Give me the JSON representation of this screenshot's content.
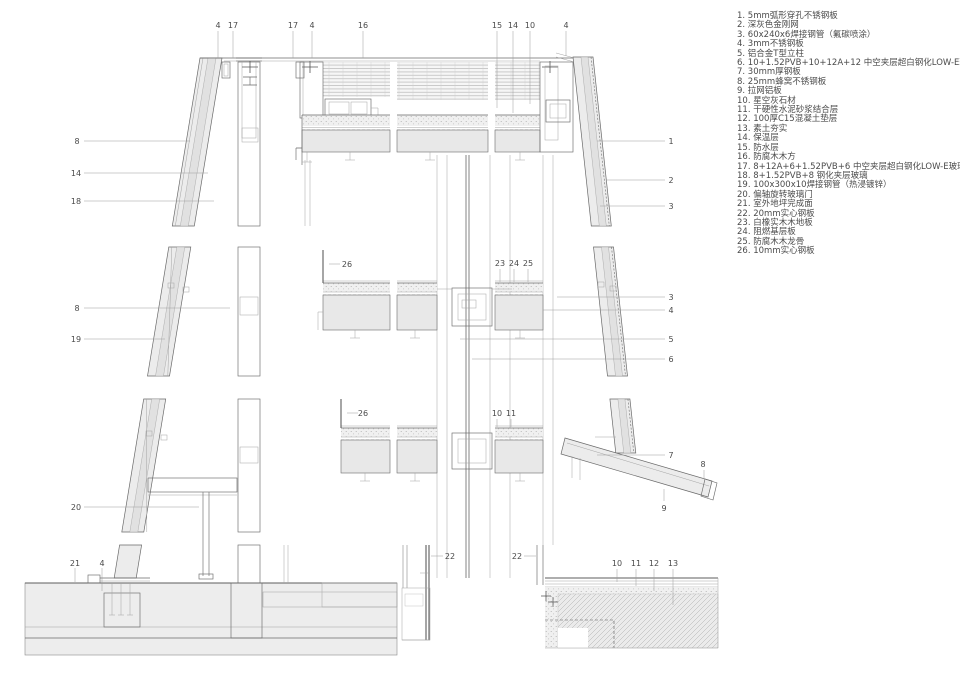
{
  "colors": {
    "line": "#6a6a6a",
    "line_light": "#a3a3a3",
    "fill": "#ececec",
    "slab": "#e8e8e8",
    "text": "#4a4a4a"
  },
  "legend": {
    "items": [
      {
        "num": "1",
        "text": "5mm弧形穿孔不锈钢板"
      },
      {
        "num": "2",
        "text": "深灰色金刚网"
      },
      {
        "num": "3",
        "text": "60x240x6焊接钢管（氟碳喷涂）"
      },
      {
        "num": "4",
        "text": "3mm不锈钢板"
      },
      {
        "num": "5",
        "text": "铝合金T型立柱"
      },
      {
        "num": "6",
        "text": "10+1.52PVB+10+12A+12 中空夹层超白钢化LOW-E玻璃"
      },
      {
        "num": "7",
        "text": "30mm厚钢板"
      },
      {
        "num": "8",
        "text": "25mm蜂窝不锈钢板"
      },
      {
        "num": "9",
        "text": "拉网铝板"
      },
      {
        "num": "10",
        "text": "星空灰石材"
      },
      {
        "num": "11",
        "text": "干硬性水泥砂浆结合层"
      },
      {
        "num": "12",
        "text": "100厚C15混凝土垫层"
      },
      {
        "num": "13",
        "text": "素土夯实"
      },
      {
        "num": "14",
        "text": "保温层"
      },
      {
        "num": "15",
        "text": "防水层"
      },
      {
        "num": "16",
        "text": "防腐木木方"
      },
      {
        "num": "17",
        "text": "8+12A+6+1.52PVB+6 中空夹层超白钢化LOW-E玻璃"
      },
      {
        "num": "18",
        "text": "8+1.52PVB+8 钢化夹层玻璃"
      },
      {
        "num": "19",
        "text": "100x300x10焊接钢管（热浸镀锌）"
      },
      {
        "num": "20",
        "text": "偏轴旋转玻璃门"
      },
      {
        "num": "21",
        "text": "室外地坪完成面"
      },
      {
        "num": "22",
        "text": "20mm实心钢板"
      },
      {
        "num": "23",
        "text": "白橡实木木地板"
      },
      {
        "num": "24",
        "text": "阻燃基层板"
      },
      {
        "num": "25",
        "text": "防腐木木龙骨"
      },
      {
        "num": "26",
        "text": "10mm实心钢板"
      }
    ]
  },
  "callouts": [
    {
      "label": "4",
      "x": 218,
      "y": 25,
      "leader": [
        218,
        31,
        218,
        58
      ]
    },
    {
      "label": "17",
      "x": 233,
      "y": 25,
      "leader": [
        233,
        31,
        233,
        58
      ]
    },
    {
      "label": "17",
      "x": 293,
      "y": 25,
      "leader": [
        293,
        31,
        293,
        58
      ]
    },
    {
      "label": "4",
      "x": 312,
      "y": 25,
      "leader": [
        312,
        31,
        312,
        58
      ]
    },
    {
      "label": "16",
      "x": 363,
      "y": 25,
      "leader": [
        363,
        31,
        363,
        58
      ]
    },
    {
      "label": "15",
      "x": 497,
      "y": 25,
      "leader": [
        497,
        31,
        497,
        108
      ]
    },
    {
      "label": "14",
      "x": 513,
      "y": 25,
      "leader": [
        513,
        31,
        513,
        113
      ]
    },
    {
      "label": "10",
      "x": 530,
      "y": 25,
      "leader": [
        530,
        31,
        530,
        104
      ]
    },
    {
      "label": "4",
      "x": 566,
      "y": 25,
      "leader": [
        566,
        31,
        566,
        56
      ]
    },
    {
      "label": "8",
      "x": 77,
      "y": 141,
      "leader": [
        84,
        141,
        190,
        141
      ]
    },
    {
      "label": "14",
      "x": 76,
      "y": 173,
      "leader": [
        84,
        173,
        208,
        173
      ]
    },
    {
      "label": "18",
      "x": 76,
      "y": 201,
      "leader": [
        84,
        201,
        214,
        201
      ]
    },
    {
      "label": "8",
      "x": 77,
      "y": 308,
      "leader": [
        84,
        308,
        230,
        308
      ]
    },
    {
      "label": "19",
      "x": 76,
      "y": 339,
      "leader": [
        84,
        339,
        165,
        339
      ]
    },
    {
      "label": "20",
      "x": 76,
      "y": 507,
      "leader": [
        84,
        507,
        199,
        507
      ]
    },
    {
      "label": "21",
      "x": 75,
      "y": 563,
      "leader": [
        75,
        568,
        75,
        582
      ]
    },
    {
      "label": "4",
      "x": 102,
      "y": 563,
      "leader": [
        102,
        568,
        102,
        591
      ]
    },
    {
      "label": "1",
      "x": 671,
      "y": 141,
      "leader": [
        597,
        141,
        665,
        141
      ]
    },
    {
      "label": "2",
      "x": 671,
      "y": 180,
      "leader": [
        606,
        180,
        665,
        180
      ]
    },
    {
      "label": "3",
      "x": 671,
      "y": 206,
      "leader": [
        600,
        206,
        665,
        206
      ]
    },
    {
      "label": "3",
      "x": 671,
      "y": 297,
      "leader": [
        557,
        297,
        665,
        297
      ]
    },
    {
      "label": "4",
      "x": 671,
      "y": 310,
      "leader": [
        543,
        310,
        665,
        310
      ]
    },
    {
      "label": "5",
      "x": 671,
      "y": 339,
      "leader": [
        460,
        339,
        665,
        339
      ]
    },
    {
      "label": "6",
      "x": 671,
      "y": 359,
      "leader": [
        472,
        359,
        665,
        359
      ]
    },
    {
      "label": "7",
      "x": 671,
      "y": 455,
      "leader": [
        597,
        455,
        665,
        455
      ]
    },
    {
      "label": "8",
      "x": 703,
      "y": 464,
      "leader": [
        704,
        470,
        704,
        479
      ]
    },
    {
      "label": "9",
      "x": 664,
      "y": 508,
      "leader": [
        664,
        489,
        664,
        501
      ]
    },
    {
      "label": "26",
      "x": 347,
      "y": 264,
      "leader": [
        329,
        264,
        340,
        264
      ]
    },
    {
      "label": "23",
      "x": 500,
      "y": 263,
      "leader": [
        500,
        269,
        500,
        282
      ]
    },
    {
      "label": "24",
      "x": 514,
      "y": 263,
      "leader": [
        514,
        269,
        514,
        282
      ]
    },
    {
      "label": "25",
      "x": 528,
      "y": 263,
      "leader": [
        528,
        269,
        528,
        282
      ]
    },
    {
      "label": "26",
      "x": 363,
      "y": 413,
      "leader": [
        347,
        413,
        358,
        413
      ]
    },
    {
      "label": "10",
      "x": 497,
      "y": 413,
      "leader": [
        497,
        419,
        497,
        427
      ]
    },
    {
      "label": "11",
      "x": 511,
      "y": 413,
      "leader": [
        511,
        419,
        511,
        427
      ]
    },
    {
      "label": "22",
      "x": 450,
      "y": 556,
      "leader": [
        431,
        556,
        443,
        556
      ]
    },
    {
      "label": "22",
      "x": 517,
      "y": 556,
      "leader": [
        524,
        556,
        536,
        556
      ]
    },
    {
      "label": "10",
      "x": 617,
      "y": 563,
      "leader": [
        617,
        569,
        617,
        582
      ]
    },
    {
      "label": "11",
      "x": 636,
      "y": 563,
      "leader": [
        636,
        569,
        636,
        586
      ]
    },
    {
      "label": "12",
      "x": 654,
      "y": 563,
      "leader": [
        654,
        569,
        654,
        591
      ]
    },
    {
      "label": "13",
      "x": 673,
      "y": 563,
      "leader": [
        673,
        569,
        673,
        605
      ]
    }
  ]
}
